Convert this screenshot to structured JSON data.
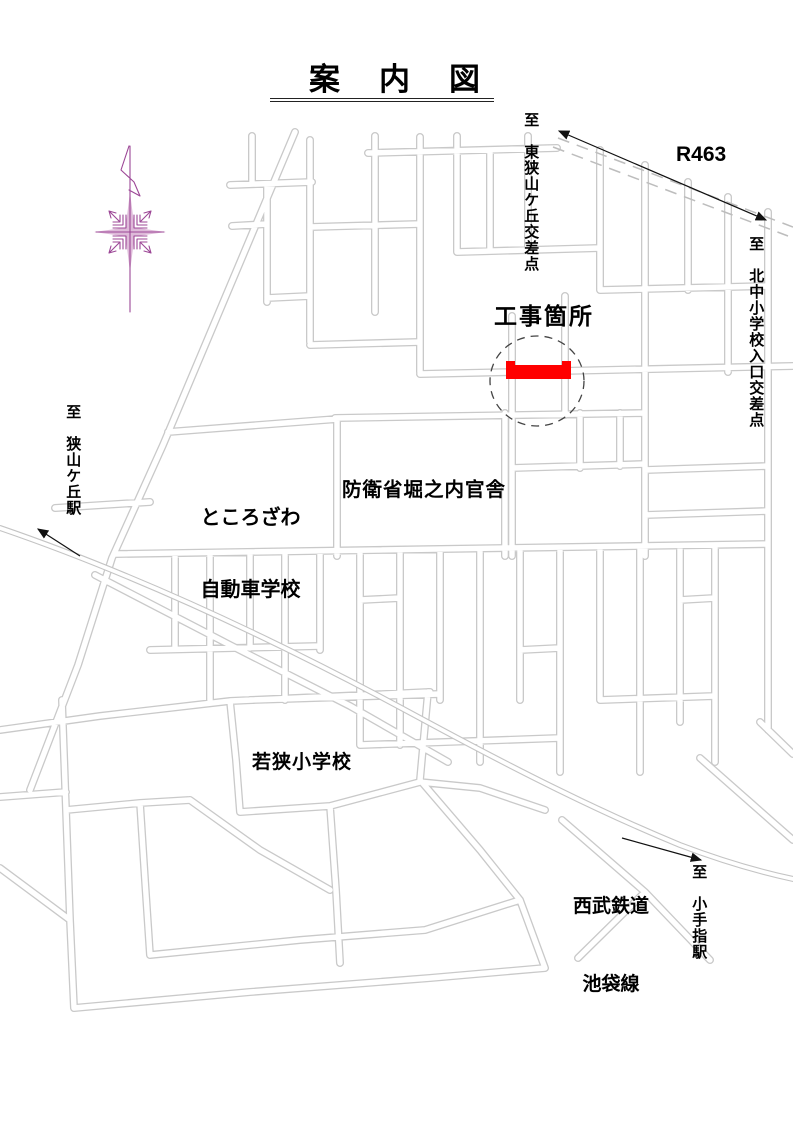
{
  "title": "案　内　図",
  "labels": {
    "to_higashi": "至　東狭山ケ丘交差点",
    "r463": "R463",
    "to_kitanaka": "至　北中小学校入口交差点",
    "construction": "工事箇所",
    "school1": "ところざわ",
    "school2": "自動車学校",
    "defense": "防衛省堀之内官舎",
    "wakasa": "若狭小学校",
    "railway1": "西武鉄道",
    "railway2": "池袋線",
    "to_kotesashi": "至　小手指駅",
    "to_sayamagaoka": "至　狭山ケ丘駅"
  },
  "colors": {
    "construction_highlight": "#ff0000",
    "road_casing": "#c9c9c9",
    "railway": "#c4c4c4",
    "compass": "#9c4796",
    "arrow": "#111111",
    "circle_dash": "#444444"
  }
}
